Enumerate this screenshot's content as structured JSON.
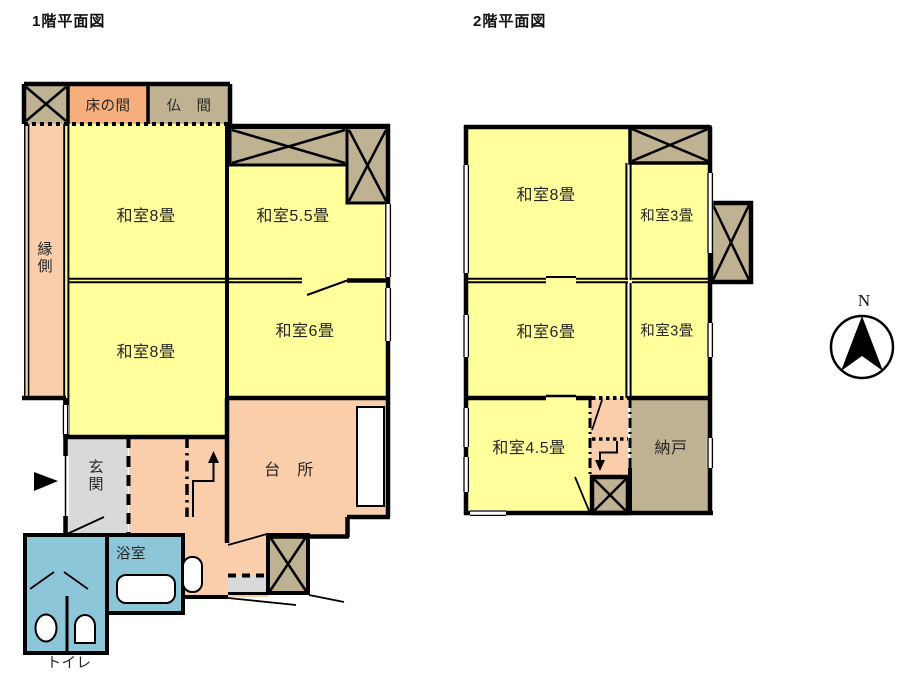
{
  "floor1": {
    "title": "1階平面図",
    "rooms": {
      "tokonoma": "床の間",
      "butsuma": "仏　間",
      "engawa": "縁側",
      "washitsu8_top": "和室8畳",
      "washitsu55": "和室5.5畳",
      "washitsu8_bottom": "和室8畳",
      "washitsu6": "和室6畳",
      "kitchen": "台　所",
      "genkan": "玄関",
      "bathroom": "浴室",
      "toilet": "トイレ"
    }
  },
  "floor2": {
    "title": "2階平面図",
    "rooms": {
      "washitsu8": "和室8畳",
      "washitsu3_top": "和室3畳",
      "washitsu6": "和室6畳",
      "washitsu3_bottom": "和室3畳",
      "washitsu45": "和室4.5畳",
      "nando": "納戸"
    }
  },
  "compass": {
    "label": "N"
  },
  "colors": {
    "tatami_yellow": "#FFFF9B",
    "wood_salmon": "#FACDAB",
    "tokonoma_orange": "#F6AE7D",
    "closet_khaki": "#BFB293",
    "entry_gray": "#D9D9D9",
    "wet_area_blue": "#8CC6D8",
    "wall_black": "#000000"
  }
}
